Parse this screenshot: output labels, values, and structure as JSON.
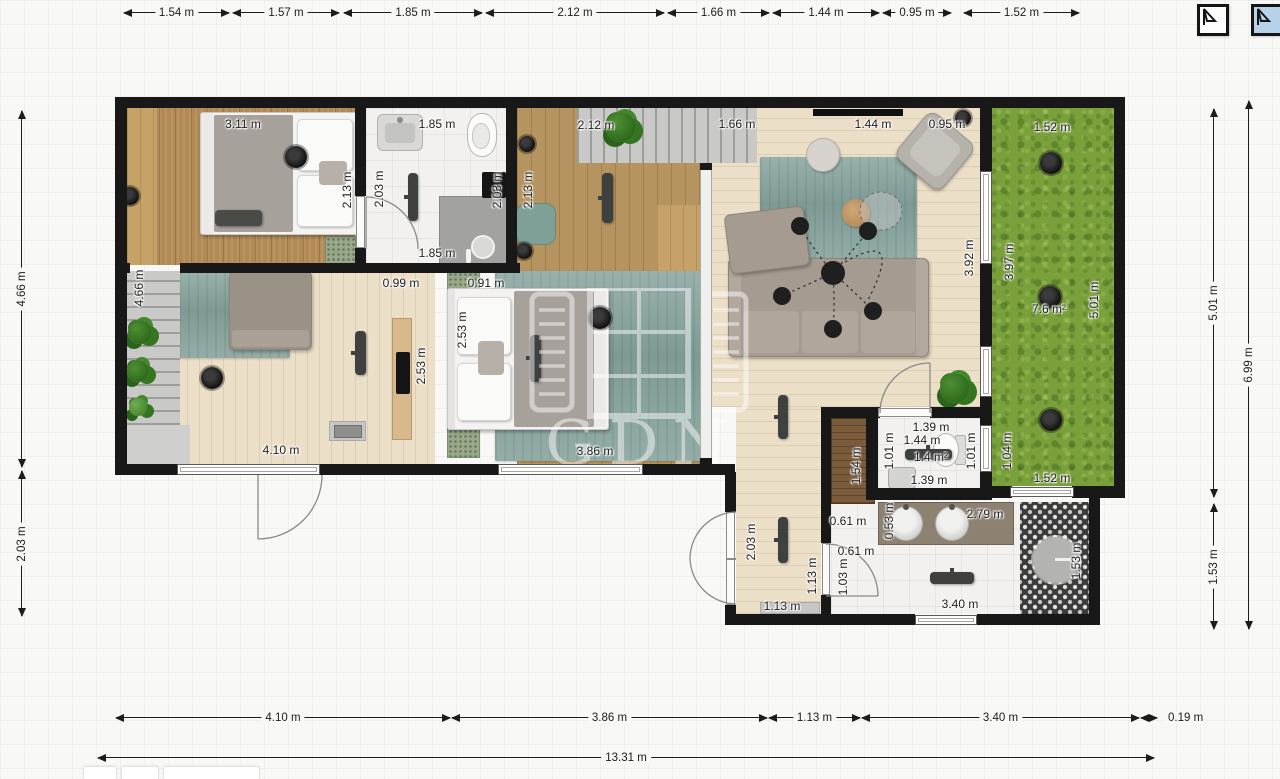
{
  "app": {
    "watermark_text": "GDN",
    "floor_selector": [
      {
        "name": "floor-tab-1",
        "active": false
      },
      {
        "name": "floor-tab-2",
        "active": true
      }
    ]
  },
  "dimensions": {
    "top": [
      "1.54 m",
      "1.57 m",
      "1.85 m",
      "2.12 m",
      "1.66 m",
      "1.44 m",
      "0.95 m",
      "1.52 m"
    ],
    "bottom": [
      "4.10 m",
      "3.86 m",
      "1.13 m",
      "3.40 m",
      "0.19 m"
    ],
    "bottom_total": "13.31 m",
    "left": [
      "4.66 m",
      "2.03 m"
    ],
    "right_inner": [
      "5.01 m",
      "1.53 m"
    ],
    "right_outer": "6.99 m"
  },
  "plan_labels": [
    "3.11 m",
    "1.85 m",
    "2.12 m",
    "1.66 m",
    "1.44 m",
    "0.95 m",
    "1.52 m",
    "2.13 m",
    "2.03 m",
    "2.03 m",
    "2.13 m",
    "1.85 m",
    "3.92 m",
    "3.97 m",
    "7.6 m²",
    "5.01 m",
    "4.66 m",
    "0.99 m",
    "0.91 m",
    "2.53 m",
    "2.53 m",
    "4.10 m",
    "3.86 m",
    "1.44 m",
    "1.39 m",
    "1.01 m",
    "1.4 m²",
    "1.01 m",
    "1.39 m",
    "1.04 m",
    "1.52 m",
    "1.54 m",
    "0.61 m",
    "0.61 m",
    "1.03 m",
    "2.03 m",
    "1.13 m",
    "1.13 m",
    "0.53 m",
    "2.79 m",
    "3.40 m",
    "1.53 m"
  ],
  "colors": {
    "wall": "#181818",
    "grass": "#7aa03c",
    "rug": "#8ba6a0",
    "wood_dark": "#b18a55",
    "wood_pale": "#ecdfc8",
    "active_floor_tab": "#b7d2e8"
  }
}
